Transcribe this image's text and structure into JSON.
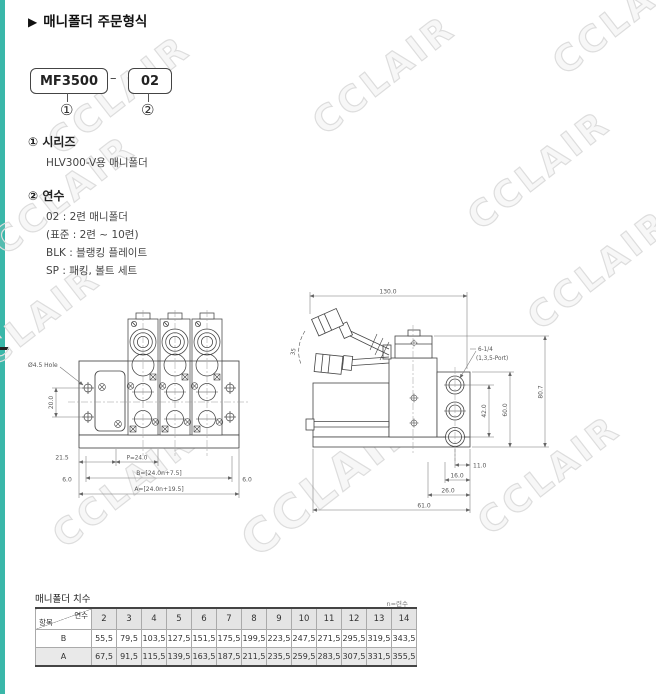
{
  "page": {
    "header_arrow": "▶",
    "title": "매니폴더 주문형식",
    "watermark_text": "CCLAIR"
  },
  "order_code": {
    "model": "MF3500",
    "dash": "–",
    "suffix": "02",
    "callout1": "①",
    "callout2": "②"
  },
  "series_section": {
    "heading_num": "①",
    "heading": "시리즈",
    "description": "HLV300-V용 매니폴더"
  },
  "station_section": {
    "heading_num": "②",
    "heading": "연수",
    "line1": "02 : 2련 매니폴더",
    "line2": "(표준 : 2련 ~ 10련)",
    "line3": "BLK :  블랭킹 플레이트",
    "line4": "SP : 패킹, 볼트 세트"
  },
  "front_view": {
    "hole_label": "Ø4.5 Hole",
    "dim_vertical": "20.0",
    "dim_21_5": "21.5",
    "dim_pitch": "P=24.0",
    "dim_b": "B=[24.0n+7.5]",
    "dim_6_left": "6.0",
    "dim_6_right": "6.0",
    "dim_a": "A=[24.0n+19.5]"
  },
  "side_view": {
    "dim_130": "130.0",
    "angle": "35",
    "port_label_line1": "6-1/4",
    "port_label_line2": "(1,3,5-Port)",
    "dim_80_7": "80.7",
    "dim_60": "60.0",
    "dim_42": "42.0",
    "dim_11": "11.0",
    "dim_16": "16.0",
    "dim_26": "26.0",
    "dim_61": "61.0"
  },
  "table": {
    "title": "매니폴더 치수",
    "note": "n=련수",
    "corner_top": "연수",
    "corner_bottom": "항목",
    "columns": [
      "2",
      "3",
      "4",
      "5",
      "6",
      "7",
      "8",
      "9",
      "10",
      "11",
      "12",
      "13",
      "14"
    ],
    "rows": [
      {
        "label": "B",
        "values": [
          "55,5",
          "79,5",
          "103,5",
          "127,5",
          "151,5",
          "175,5",
          "199,5",
          "223,5",
          "247,5",
          "271,5",
          "295,5",
          "319,5",
          "343,5"
        ]
      },
      {
        "label": "A",
        "values": [
          "67,5",
          "91,5",
          "115,5",
          "139,5",
          "163,5",
          "187,5",
          "211,5",
          "235,5",
          "259,5",
          "283,5",
          "307,5",
          "331,5",
          "355,5"
        ]
      }
    ]
  }
}
